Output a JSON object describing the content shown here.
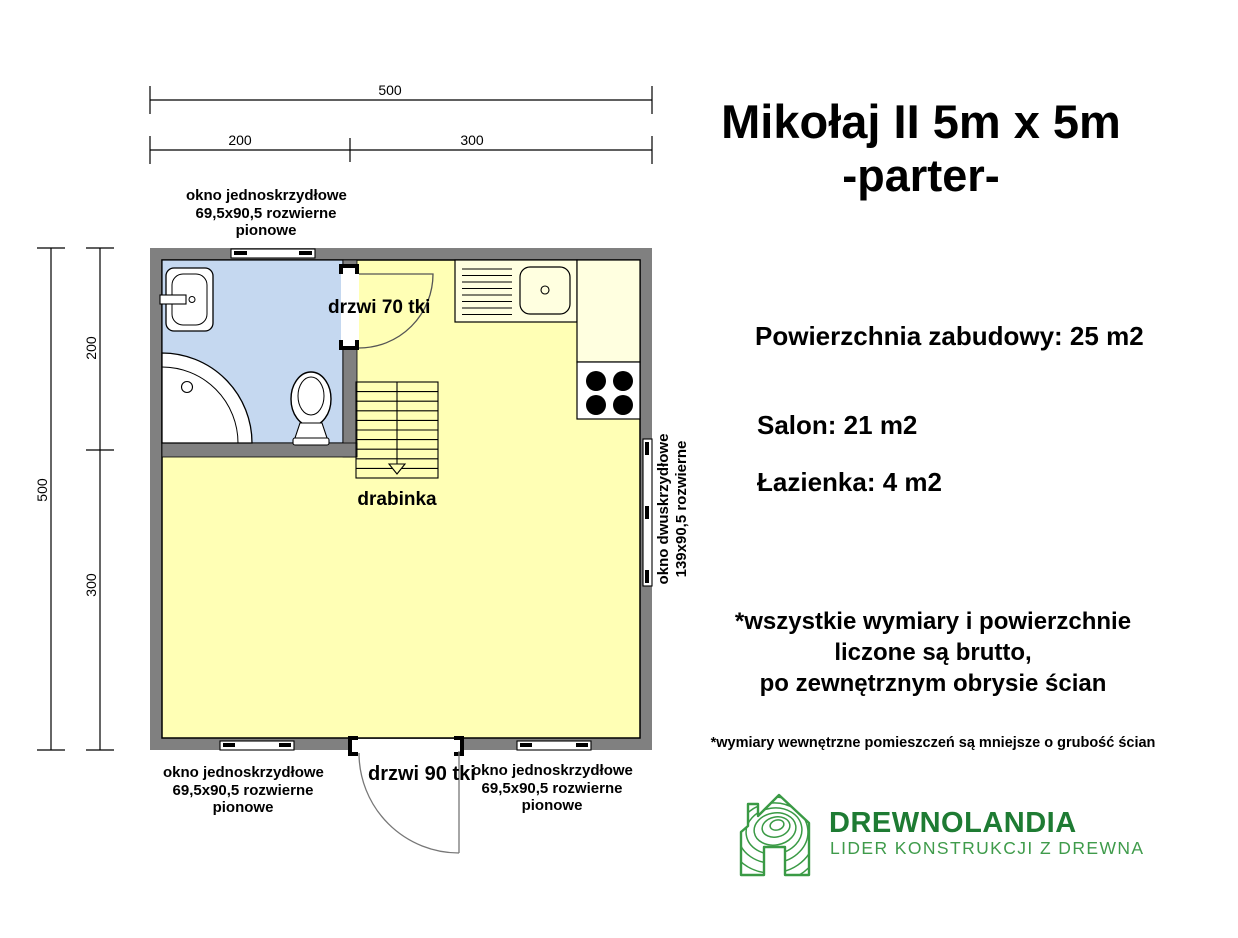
{
  "title": {
    "line1": "Mikołaj II 5m x 5m",
    "line2": "-parter-"
  },
  "stats": {
    "built_area": "Powierzchnia zabudowy: 25 m2",
    "salon": "Salon: 21 m2",
    "bathroom": "Łazienka: 4 m2"
  },
  "notes": {
    "gross": [
      "*wszystkie wymiary i powierzchnie",
      "liczone są brutto,",
      "po zewnętrznym obrysie ścian"
    ],
    "internal": "*wymiary wewnętrzne pomieszczeń są mniejsze o grubość ścian"
  },
  "logo": {
    "brand": "DREWNOLANDIA",
    "tagline": "LIDER KONSTRUKCJI Z DREWNA",
    "brand_color": "#1e7b33",
    "tagline_color": "#3f9b4b"
  },
  "plan": {
    "dimensions": {
      "top_total": "500",
      "top_left": "200",
      "top_right": "300",
      "left_total": "500",
      "left_top": "200",
      "left_bottom": "300"
    },
    "labels": {
      "window_top": [
        "okno jednoskrzydłowe",
        "69,5x90,5 rozwierne",
        "pionowe"
      ],
      "door_interior": "drzwi 70 tki",
      "ladder": "drabinka",
      "window_right": [
        "okno dwuskrzydłowe",
        "139x90,5 rozwierne"
      ],
      "window_bottom_left": [
        "okno jednoskrzydłowe",
        "69,5x90,5 rozwierne",
        "pionowe"
      ],
      "door_exterior": "drzwi 90 tki",
      "window_bottom_right": [
        "okno jednoskrzydłowe",
        "69,5x90,5 rozwierne",
        "pionowe"
      ]
    },
    "colors": {
      "wall": "#808080",
      "salon_fill": "#ffffb5",
      "bathroom_fill": "#c5d8f0",
      "counter_fill": "#ffffe0"
    }
  }
}
